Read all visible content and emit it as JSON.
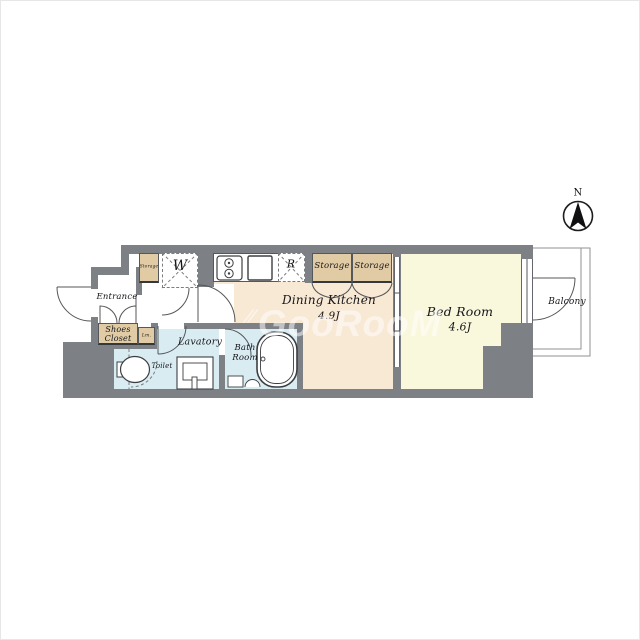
{
  "palette": {
    "wall": "#7d8186",
    "line": "#54575b",
    "peach": "#f8e9d4",
    "yellow": "#f9f7dc",
    "blue": "#d9ecf2",
    "tan": "#e1cba4",
    "dash": "#7a7d80",
    "fixture": "#3c3f42"
  },
  "compass": {
    "label": "N"
  },
  "watermark": {
    "mark": "⁄⁄",
    "text": "GooRooM"
  },
  "rooms": {
    "entrance": {
      "label": "Entrance"
    },
    "shoes_closet": {
      "label": "Shoes\nCloset"
    },
    "linen": {
      "label": "Lm."
    },
    "storage_hall": {
      "label": "Storage"
    },
    "washer": {
      "label": "W"
    },
    "fridge": {
      "label": "R"
    },
    "storage_1": {
      "label": "Storage"
    },
    "storage_2": {
      "label": "Storage"
    },
    "dining_kitchen": {
      "label": "Dining Kitchen",
      "size": "4.9J"
    },
    "bed_room": {
      "label": "Bed Room",
      "size": "4.6J"
    },
    "balcony": {
      "label": "Balcony"
    },
    "lavatory": {
      "label": "Lavatory"
    },
    "bath_room": {
      "label": "Bath\nRoom"
    },
    "toilet": {
      "label": "Toilet"
    }
  }
}
